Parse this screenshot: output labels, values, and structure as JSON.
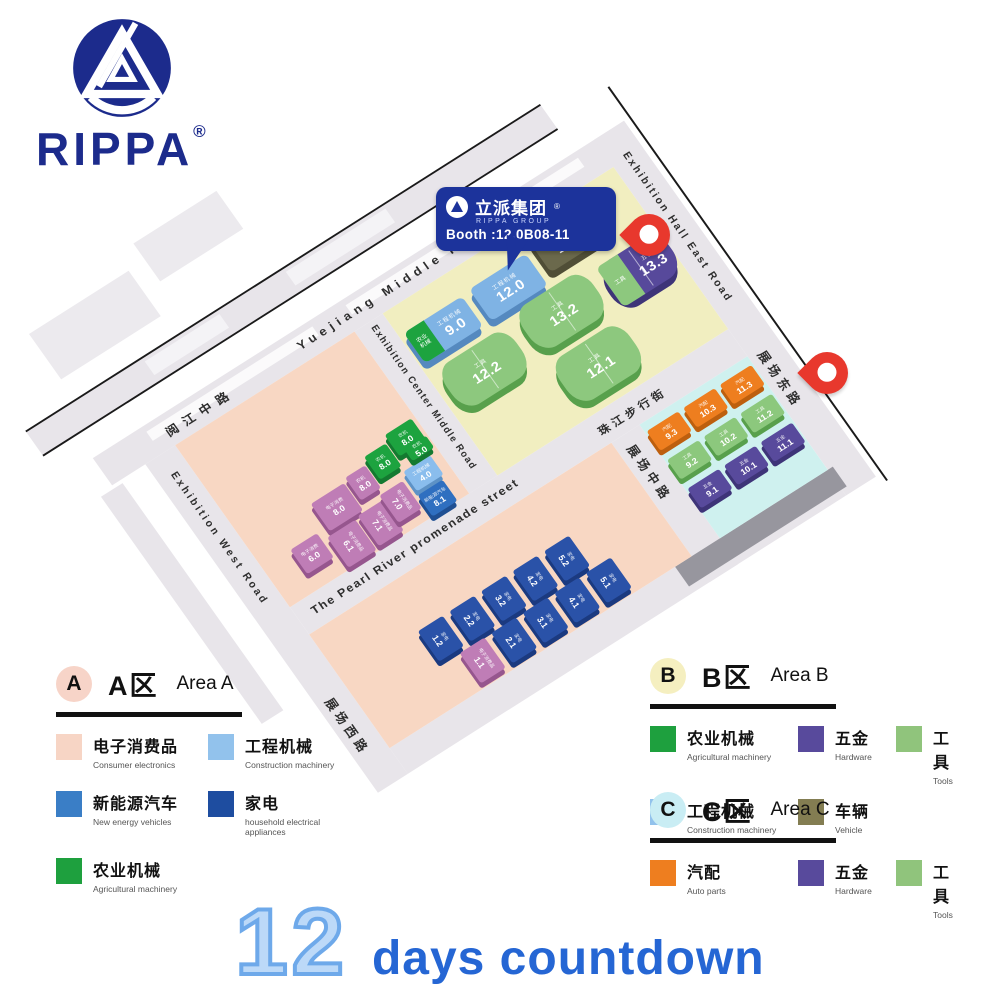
{
  "logo": {
    "brand": "RIPPA",
    "registered": "®"
  },
  "callout": {
    "company_cn": "立派集团",
    "registered": "®",
    "company_en": "RIPPA GROUP",
    "booth_label": "Booth :12.0B08-11",
    "bg_color": "#1c339b"
  },
  "countdown": {
    "number": "12",
    "text": "days countdown"
  },
  "map": {
    "pin_color": "#e8382d",
    "zone_colors": {
      "area_a": "#f8d7c3",
      "area_b": "#f1eec0",
      "area_c": "#cff1ef",
      "road": "#e8e5ea"
    },
    "roads": {
      "yuejiang_en": "Yuejiang Middle Road",
      "yuejiang_cn": "阅江中路",
      "east_en": "Exhibition Hall East Road",
      "east_cn": "展场东路",
      "west_en": "Exhibition West Road",
      "west_cn": "展场西路",
      "center_en": "Exhibition Center Middle Road",
      "promenade_en": "The Pearl River promenade street",
      "promenade_cn": "珠江步行街",
      "middle_cn": "展场中路"
    },
    "category_colors": {
      "consumer": {
        "top": "#bf7db6",
        "side": "#96568e"
      },
      "appliance": {
        "top": "#2a52a8",
        "side": "#1b3a80"
      },
      "agri": {
        "top": "#1da33f",
        "side": "#147a30"
      },
      "construction": {
        "top": "#8abded",
        "side": "#5d92c6"
      },
      "nev": {
        "top": "#2f6fc0",
        "side": "#1f4f92"
      },
      "auto": {
        "top": "#ee7e1f",
        "side": "#bd5f0e"
      },
      "tools": {
        "top": "#8cc87d",
        "side": "#58a04c"
      },
      "hardware": {
        "top": "#584a9c",
        "side": "#3e3478"
      }
    },
    "halls": [
      {
        "id": "9.0",
        "category": "工程机械",
        "color": "#7fb3e4",
        "side": "#5589bf",
        "accent": {
          "category": "农业机械",
          "color": "#1da33f",
          "side": "#147a30"
        }
      },
      {
        "id": "12.0",
        "category": "工程机械",
        "color": "#7fb3e4",
        "side": "#5589bf"
      },
      {
        "id": "13.0",
        "category": "车辆",
        "color": "#6b694c",
        "side": "#504e36"
      },
      {
        "id": "12.2",
        "category": "工具",
        "color": "#8dc87e",
        "side": "#58a04c"
      },
      {
        "id": "13.2",
        "category": "工具",
        "color": "#8dc87e",
        "side": "#58a04c"
      },
      {
        "id": "13.3",
        "category": "五金",
        "color": "#57499b",
        "side": "#3e3478",
        "accent": {
          "category": "工具",
          "color": "#8dc87e",
          "side": "#58a04c"
        }
      },
      {
        "id": "12.1",
        "category": "工具",
        "color": "#8dc87e",
        "side": "#58a04c"
      }
    ],
    "area_a_booths": [
      {
        "id": "8.0",
        "category": "电子消费",
        "type": "consumer"
      },
      {
        "id": "8.0",
        "category": "农机",
        "type": "consumer"
      },
      {
        "id": "8.0",
        "category": "农机",
        "type": "agri"
      },
      {
        "id": "8.0",
        "category": "农机",
        "type": "agri"
      },
      {
        "id": "6.0",
        "category": "电子消费",
        "type": "consumer"
      },
      {
        "id": "6.1",
        "category": "电子消费品",
        "type": "consumer",
        "rot": true
      },
      {
        "id": "7.1",
        "category": "电子消费品",
        "type": "consumer",
        "rot": true
      },
      {
        "id": "7.0",
        "category": "电子消费品",
        "type": "consumer",
        "rot": true
      },
      {
        "id": "4.0",
        "category": "工程机械",
        "type": "construction"
      },
      {
        "id": "5.0",
        "category": "农机",
        "type": "agri"
      },
      {
        "id": "8.1",
        "category": "新能源汽车",
        "type": "nev"
      }
    ],
    "area_bottom_booths": [
      {
        "id": "1.2",
        "category": "家电",
        "type": "appliance",
        "rot": true
      },
      {
        "id": "2.2",
        "category": "家电",
        "type": "appliance",
        "rot": true
      },
      {
        "id": "3.2",
        "category": "家电",
        "type": "appliance",
        "rot": true
      },
      {
        "id": "4.2",
        "category": "家电",
        "type": "appliance",
        "rot": true
      },
      {
        "id": "5.2",
        "category": "家电",
        "type": "appliance",
        "rot": true
      },
      {
        "id": "1.1",
        "category": "电子消费品",
        "type": "consumer",
        "rot": true
      },
      {
        "id": "2.1",
        "category": "家电",
        "type": "appliance",
        "rot": true
      },
      {
        "id": "3.1",
        "category": "家电",
        "type": "appliance",
        "rot": true
      },
      {
        "id": "4.1",
        "category": "家电",
        "type": "appliance",
        "rot": true
      },
      {
        "id": "5.1",
        "category": "家电",
        "type": "appliance",
        "rot": true
      }
    ],
    "area_c_booths": [
      {
        "id": "9.3",
        "category": "汽配",
        "type": "auto"
      },
      {
        "id": "10.3",
        "category": "汽配",
        "type": "auto"
      },
      {
        "id": "11.3",
        "category": "汽配",
        "type": "auto"
      },
      {
        "id": "9.2",
        "category": "工具",
        "type": "tools"
      },
      {
        "id": "10.2",
        "category": "工具",
        "type": "tools"
      },
      {
        "id": "11.2",
        "category": "工具",
        "type": "tools"
      },
      {
        "id": "9.1",
        "category": "五金",
        "type": "hardware"
      },
      {
        "id": "10.1",
        "category": "五金",
        "type": "hardware"
      },
      {
        "id": "11.1",
        "category": "五金",
        "type": "hardware"
      }
    ]
  },
  "legend": {
    "areas": [
      {
        "key": "A",
        "circle_color": "#f7d4c8",
        "cn": "A区",
        "en": "Area A",
        "items": [
          {
            "cn": "电子消费品",
            "en": "Consumer electronics",
            "color": "#f7d5c5"
          },
          {
            "cn": "工程机械",
            "en": "Construction machinery",
            "color": "#92c2ec"
          },
          {
            "cn": "新能源汽车",
            "en": "New energy vehicles",
            "color": "#3a7ec6"
          },
          {
            "cn": "家电",
            "en": "household electrical appliances",
            "color": "#1e4da0"
          },
          {
            "cn": "农业机械",
            "en": "Agricultural machinery",
            "color": "#1ea03e"
          }
        ]
      },
      {
        "key": "B",
        "circle_color": "#f5efc0",
        "cn": "B区",
        "en": "Area B",
        "items": [
          {
            "cn": "农业机械",
            "en": "Agricultural machinery",
            "color": "#1ea03e"
          },
          {
            "cn": "五金",
            "en": "Hardware",
            "color": "#584a9c"
          },
          {
            "cn": "工具",
            "en": "Tools",
            "color": "#90c47c"
          },
          {
            "cn": "工程机械",
            "en": "Construction machinery",
            "color": "#92c2ec"
          },
          {
            "cn": "车辆",
            "en": "Vehicle",
            "color": "#837d52"
          }
        ]
      },
      {
        "key": "C",
        "circle_color": "#c9edf4",
        "cn": "C区",
        "en": "Area C",
        "items": [
          {
            "cn": "汽配",
            "en": "Auto parts",
            "color": "#ee7e1f"
          },
          {
            "cn": "五金",
            "en": "Hardware",
            "color": "#584a9c"
          },
          {
            "cn": "工具",
            "en": "Tools",
            "color": "#90c47c"
          }
        ]
      }
    ]
  }
}
